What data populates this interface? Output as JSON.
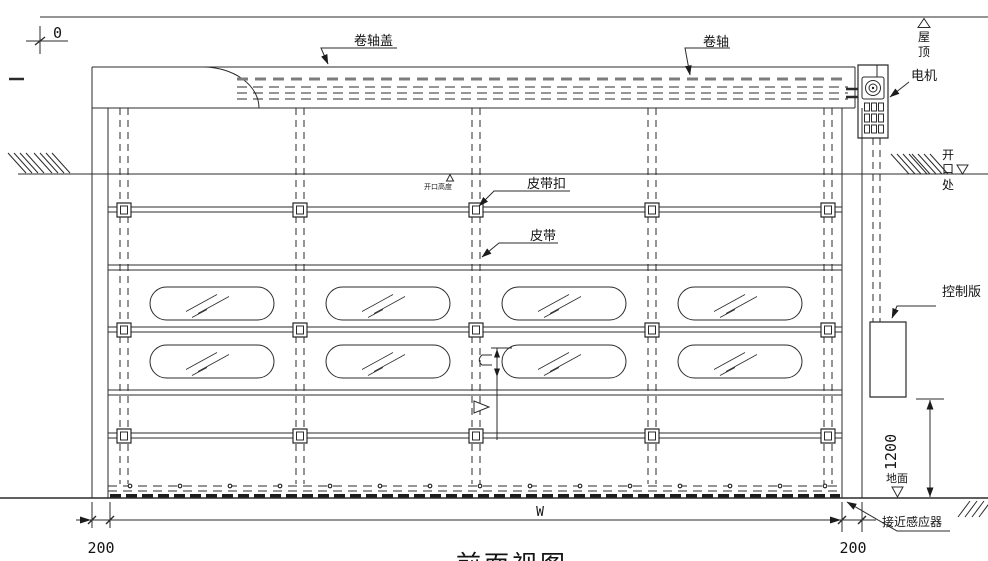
{
  "drawing": {
    "caption": "前面视图",
    "labels": {
      "roller_cover": "卷轴盖",
      "roller_shaft": "卷轴",
      "motor": "电机",
      "roof_chars": [
        "屋",
        "顶"
      ],
      "opening_chars": [
        "开",
        "口",
        "处"
      ],
      "opening_height": "开口高度",
      "belt_buckle": "皮带扣",
      "belt": "皮带",
      "control_panel": "控制版",
      "ground": "地面",
      "proximity_sensor": "接近感应器"
    },
    "dimensions": {
      "datum": "0",
      "left_frame_width": "200",
      "right_frame_width": "200",
      "door_width": "W",
      "panel_height": "1200"
    },
    "colors": {
      "line": "#2b2b2b",
      "background": "#ffffff"
    }
  }
}
